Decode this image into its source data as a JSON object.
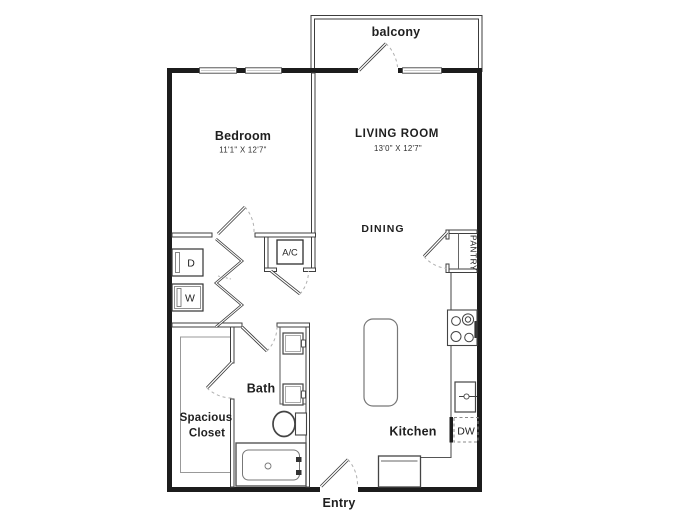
{
  "plan": {
    "type": "apartment-floor-plan",
    "rooms": {
      "bedroom": {
        "label": "Bedroom",
        "dimensions": "11'1\" X 12'7\""
      },
      "living_room": {
        "label": "LIVING ROOM",
        "dimensions": "13'0\" X 12'7\""
      },
      "dining": {
        "label": "DINING"
      },
      "kitchen": {
        "label": "Kitchen"
      },
      "bath": {
        "label": "Bath"
      },
      "closet": {
        "label_line1": "Spacious",
        "label_line2": "Closet"
      },
      "pantry": {
        "label": "PANTRY"
      },
      "balcony": {
        "label": "balcony"
      },
      "entry": {
        "label": "Entry"
      }
    },
    "appliances": {
      "ac": "A/C",
      "dryer": "D",
      "washer": "W",
      "dishwasher": "DW"
    },
    "colors": {
      "exterior_wall": "#1c1c1c",
      "interior_wall": "#3f3f3f",
      "fixture": "#555555",
      "door_arc": "#b0b0b0",
      "text": "#1f1f1f",
      "background": "#ffffff"
    }
  }
}
